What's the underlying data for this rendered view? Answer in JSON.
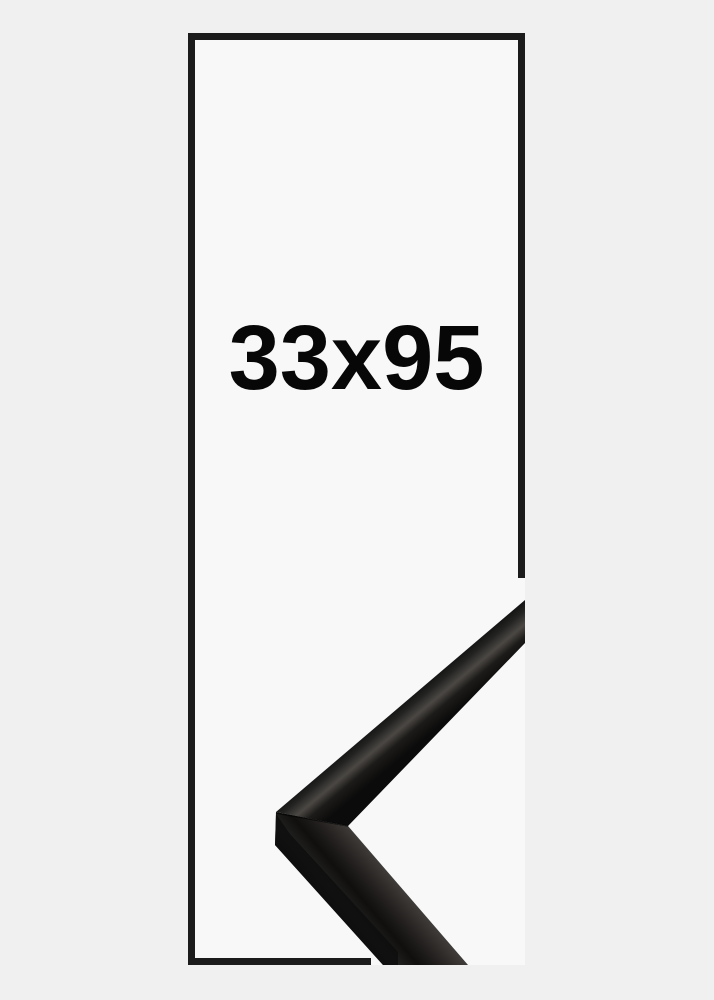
{
  "size_label": {
    "text": "33x95",
    "width_cm": 33,
    "height_cm": 95
  },
  "colors": {
    "background": "#F0F0F1",
    "panel": "#F8F8F9",
    "outline": "#1B1B1B",
    "label": "#070707"
  },
  "moulding": {
    "description": "black metal frame corner sample",
    "edge": "#070707",
    "dark": "#0B0B0B",
    "dark2": "#232322",
    "sheen": "#4B4844",
    "sheen_soft": "#3E3B38",
    "mid": "#242120",
    "shadow": "#1D1B19",
    "deep": "#100F0E",
    "side": "#0C0C0C",
    "seam": "#000000"
  }
}
